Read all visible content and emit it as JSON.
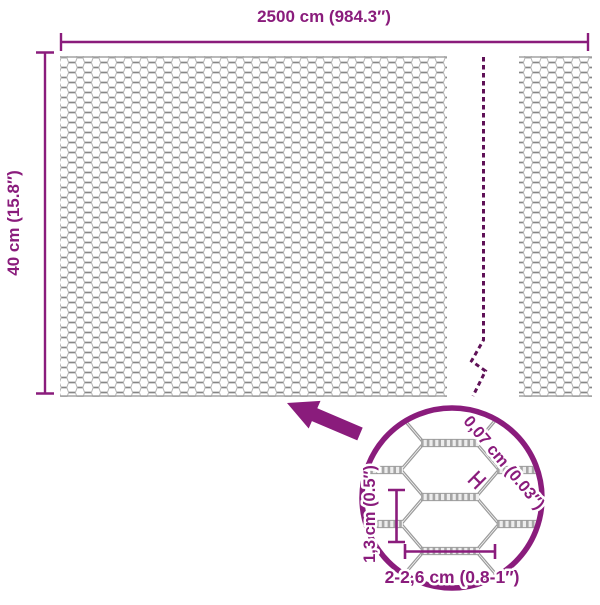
{
  "diagram": {
    "overall": {
      "width_label": "2500 cm (984.3″)",
      "height_label": "40 cm (15.8″)"
    },
    "detail": {
      "wire_diameter_label": "0,07 cm (0.03″)",
      "cell_height_label": "1,3 cm (0.5″)",
      "cell_width_label": "2-2,6 cm (0.8-1″)"
    },
    "colors": {
      "accent": "#8a1c7c",
      "wire_gray": "#9a9a9a"
    }
  }
}
